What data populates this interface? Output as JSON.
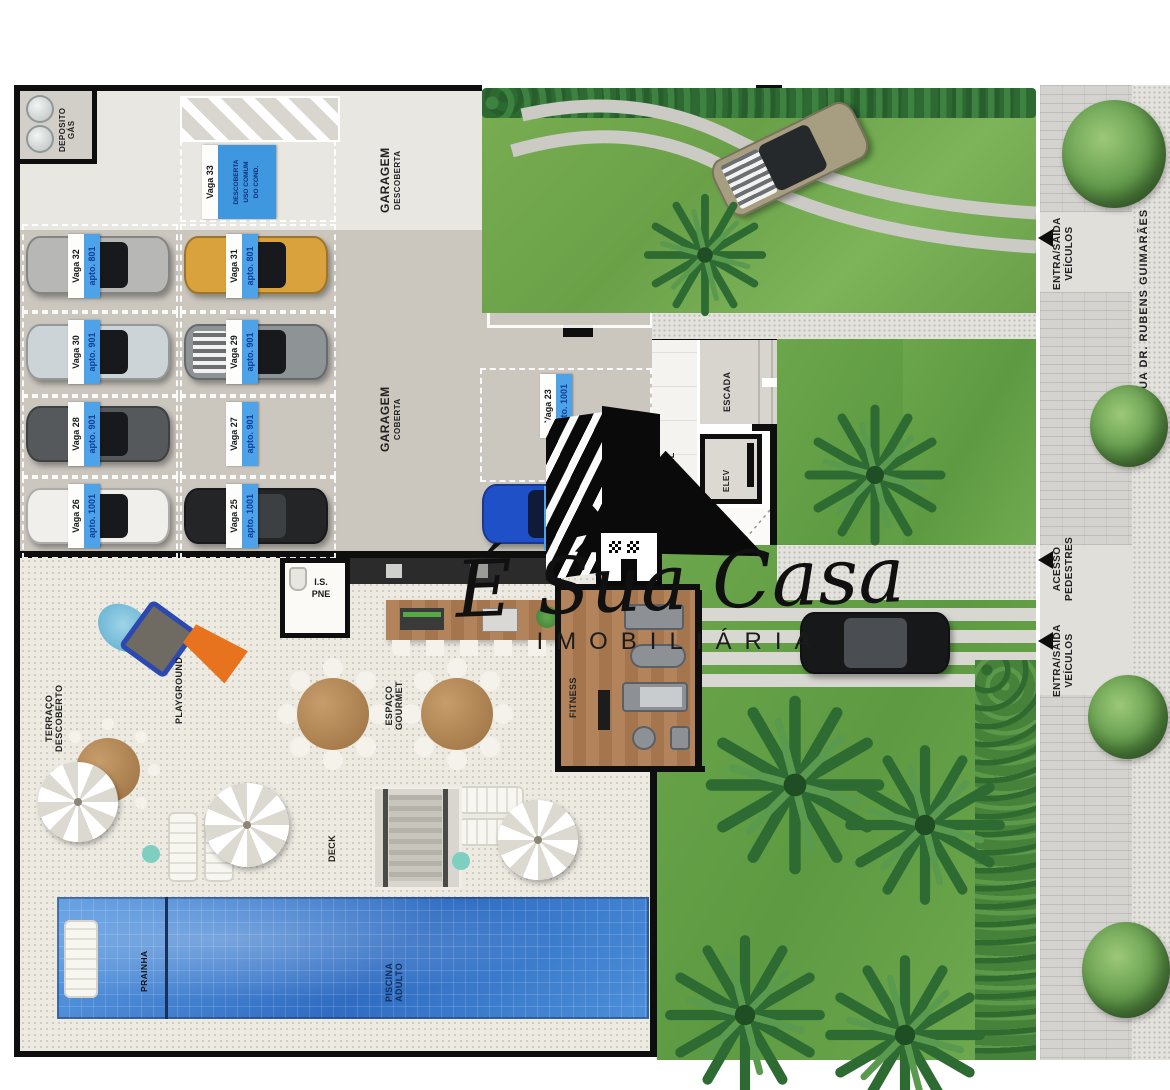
{
  "watermark": {
    "brand_script": "É Sua Casa",
    "brand_sub": "IMOBILIÁRIA"
  },
  "garage": {
    "deposito_l1": "DEPOSITO",
    "deposito_l2": "GÁS",
    "descoberta_l1": "GARAGEM",
    "descoberta_l2": "DESCOBERTA",
    "coberta_l1": "GARAGEM",
    "coberta_l2": "COBERTA",
    "vagas": [
      {
        "vaga": "Vaga 32",
        "apto": "apto. 801"
      },
      {
        "vaga": "Vaga 31",
        "apto": "apto. 801"
      },
      {
        "vaga": "Vaga 30",
        "apto": "apto. 901"
      },
      {
        "vaga": "Vaga 29",
        "apto": "apto. 901"
      },
      {
        "vaga": "Vaga 28",
        "apto": "apto. 901"
      },
      {
        "vaga": "Vaga 27",
        "apto": "apto. 901"
      },
      {
        "vaga": "Vaga 26",
        "apto": "apto. 1001"
      },
      {
        "vaga": "Vaga 25",
        "apto": "apto. 1001"
      },
      {
        "vaga": "Vaga 22",
        "apto": "apto. 801"
      },
      {
        "vaga": "Vaga 23",
        "apto": "apto. 1001"
      },
      {
        "vaga": "",
        "apto": "apto. 1001"
      }
    ],
    "vaga33": {
      "vaga": "Vaga 33",
      "sign_l1": "DESCOBERTA",
      "sign_l2": "USO COMUM",
      "sign_l3": "DO COND."
    }
  },
  "core": {
    "escada": "ESCADA",
    "elev": "ELEV",
    "hall": "HALL"
  },
  "amenities": {
    "terraco_l1": "TERRAÇO",
    "terraco_l2": "DESCOBERTO",
    "playground": "PLAYGROUND",
    "is_pne_l1": "I.S.",
    "is_pne_l2": "PNE",
    "gourmet_l1": "ESPAÇO",
    "gourmet_l2": "GOURMET",
    "fitness": "FITNESS",
    "deck": "DECK",
    "prainha": "PRAINHA",
    "piscina_l1": "PISCINA",
    "piscina_l2": "ADULTO"
  },
  "street": {
    "entrance_top_l1": "ENTRA/SAÍDA",
    "entrance_top_l2": "VEÍCULOS",
    "pedestres_l1": "ACESSO",
    "pedestres_l2": "PEDESTRES",
    "entrance_bottom_l1": "ENTRA/SAÍDA",
    "entrance_bottom_l2": "VEÍCULOS",
    "rua": "RUA DR. RUBENS GUIMARÃES"
  },
  "colors": {
    "label_blue": "#4da2e8",
    "pool_blue": "#3f7fd0",
    "grass_green": "#6aa148"
  }
}
